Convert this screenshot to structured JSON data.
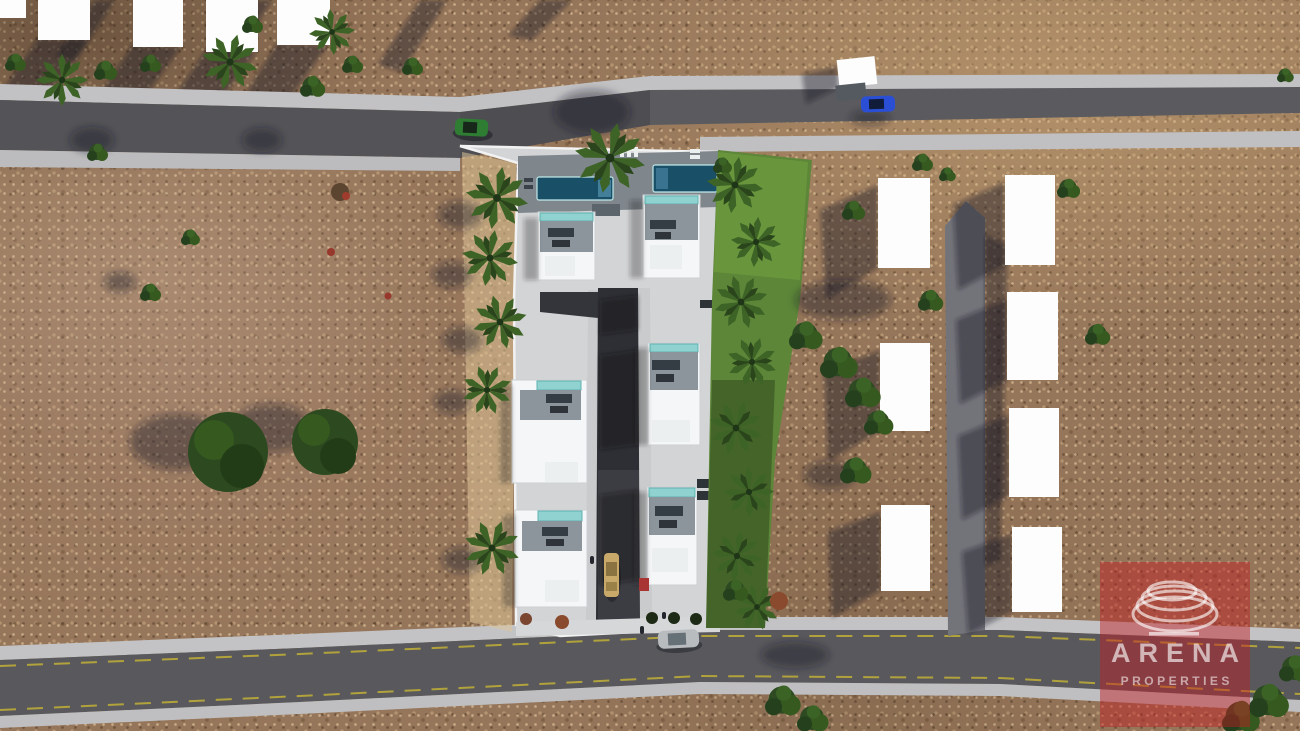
{
  "watermark": {
    "brand": "ARENA",
    "tagline": "PROPERTIES",
    "logo_icon": "arena-rings-icon"
  },
  "scene": {
    "description": "Aerial 3D architectural render of a villa development site plan on brown scrubland",
    "development": {
      "villas": 6,
      "visible_pools": 2,
      "garden_strip": "lawn with palm trees on east side",
      "internal_road": "dark asphalt driveway running north-south"
    },
    "placeholder_plots": {
      "top_row_white_blocks": 4,
      "right_area_white_blocks": 7,
      "near_road_white_block": 1
    },
    "vehicles": {
      "green_car_on_west_road": 1,
      "blue_car_on_northeast_road": 1,
      "silver_car_on_south_road": 1,
      "gold_car_on_internal_driveway": 1
    }
  },
  "colors": {
    "accent_red": "#c21c23",
    "dirt_brown": "#96765a",
    "asphalt_gray": "#5b5b5f",
    "sidewalk_gray": "#c2c2c4",
    "internal_road": "#2e2f35",
    "plot_paving": "#d3d4d6",
    "roof_white": "#f5f6f7",
    "terrace_gray": "#8c959c",
    "pool_teal": "#8fd2cf",
    "pool_deep": "#1a4f68",
    "lawn_green": "#5d8639",
    "tree_green": "#2e4d22"
  }
}
